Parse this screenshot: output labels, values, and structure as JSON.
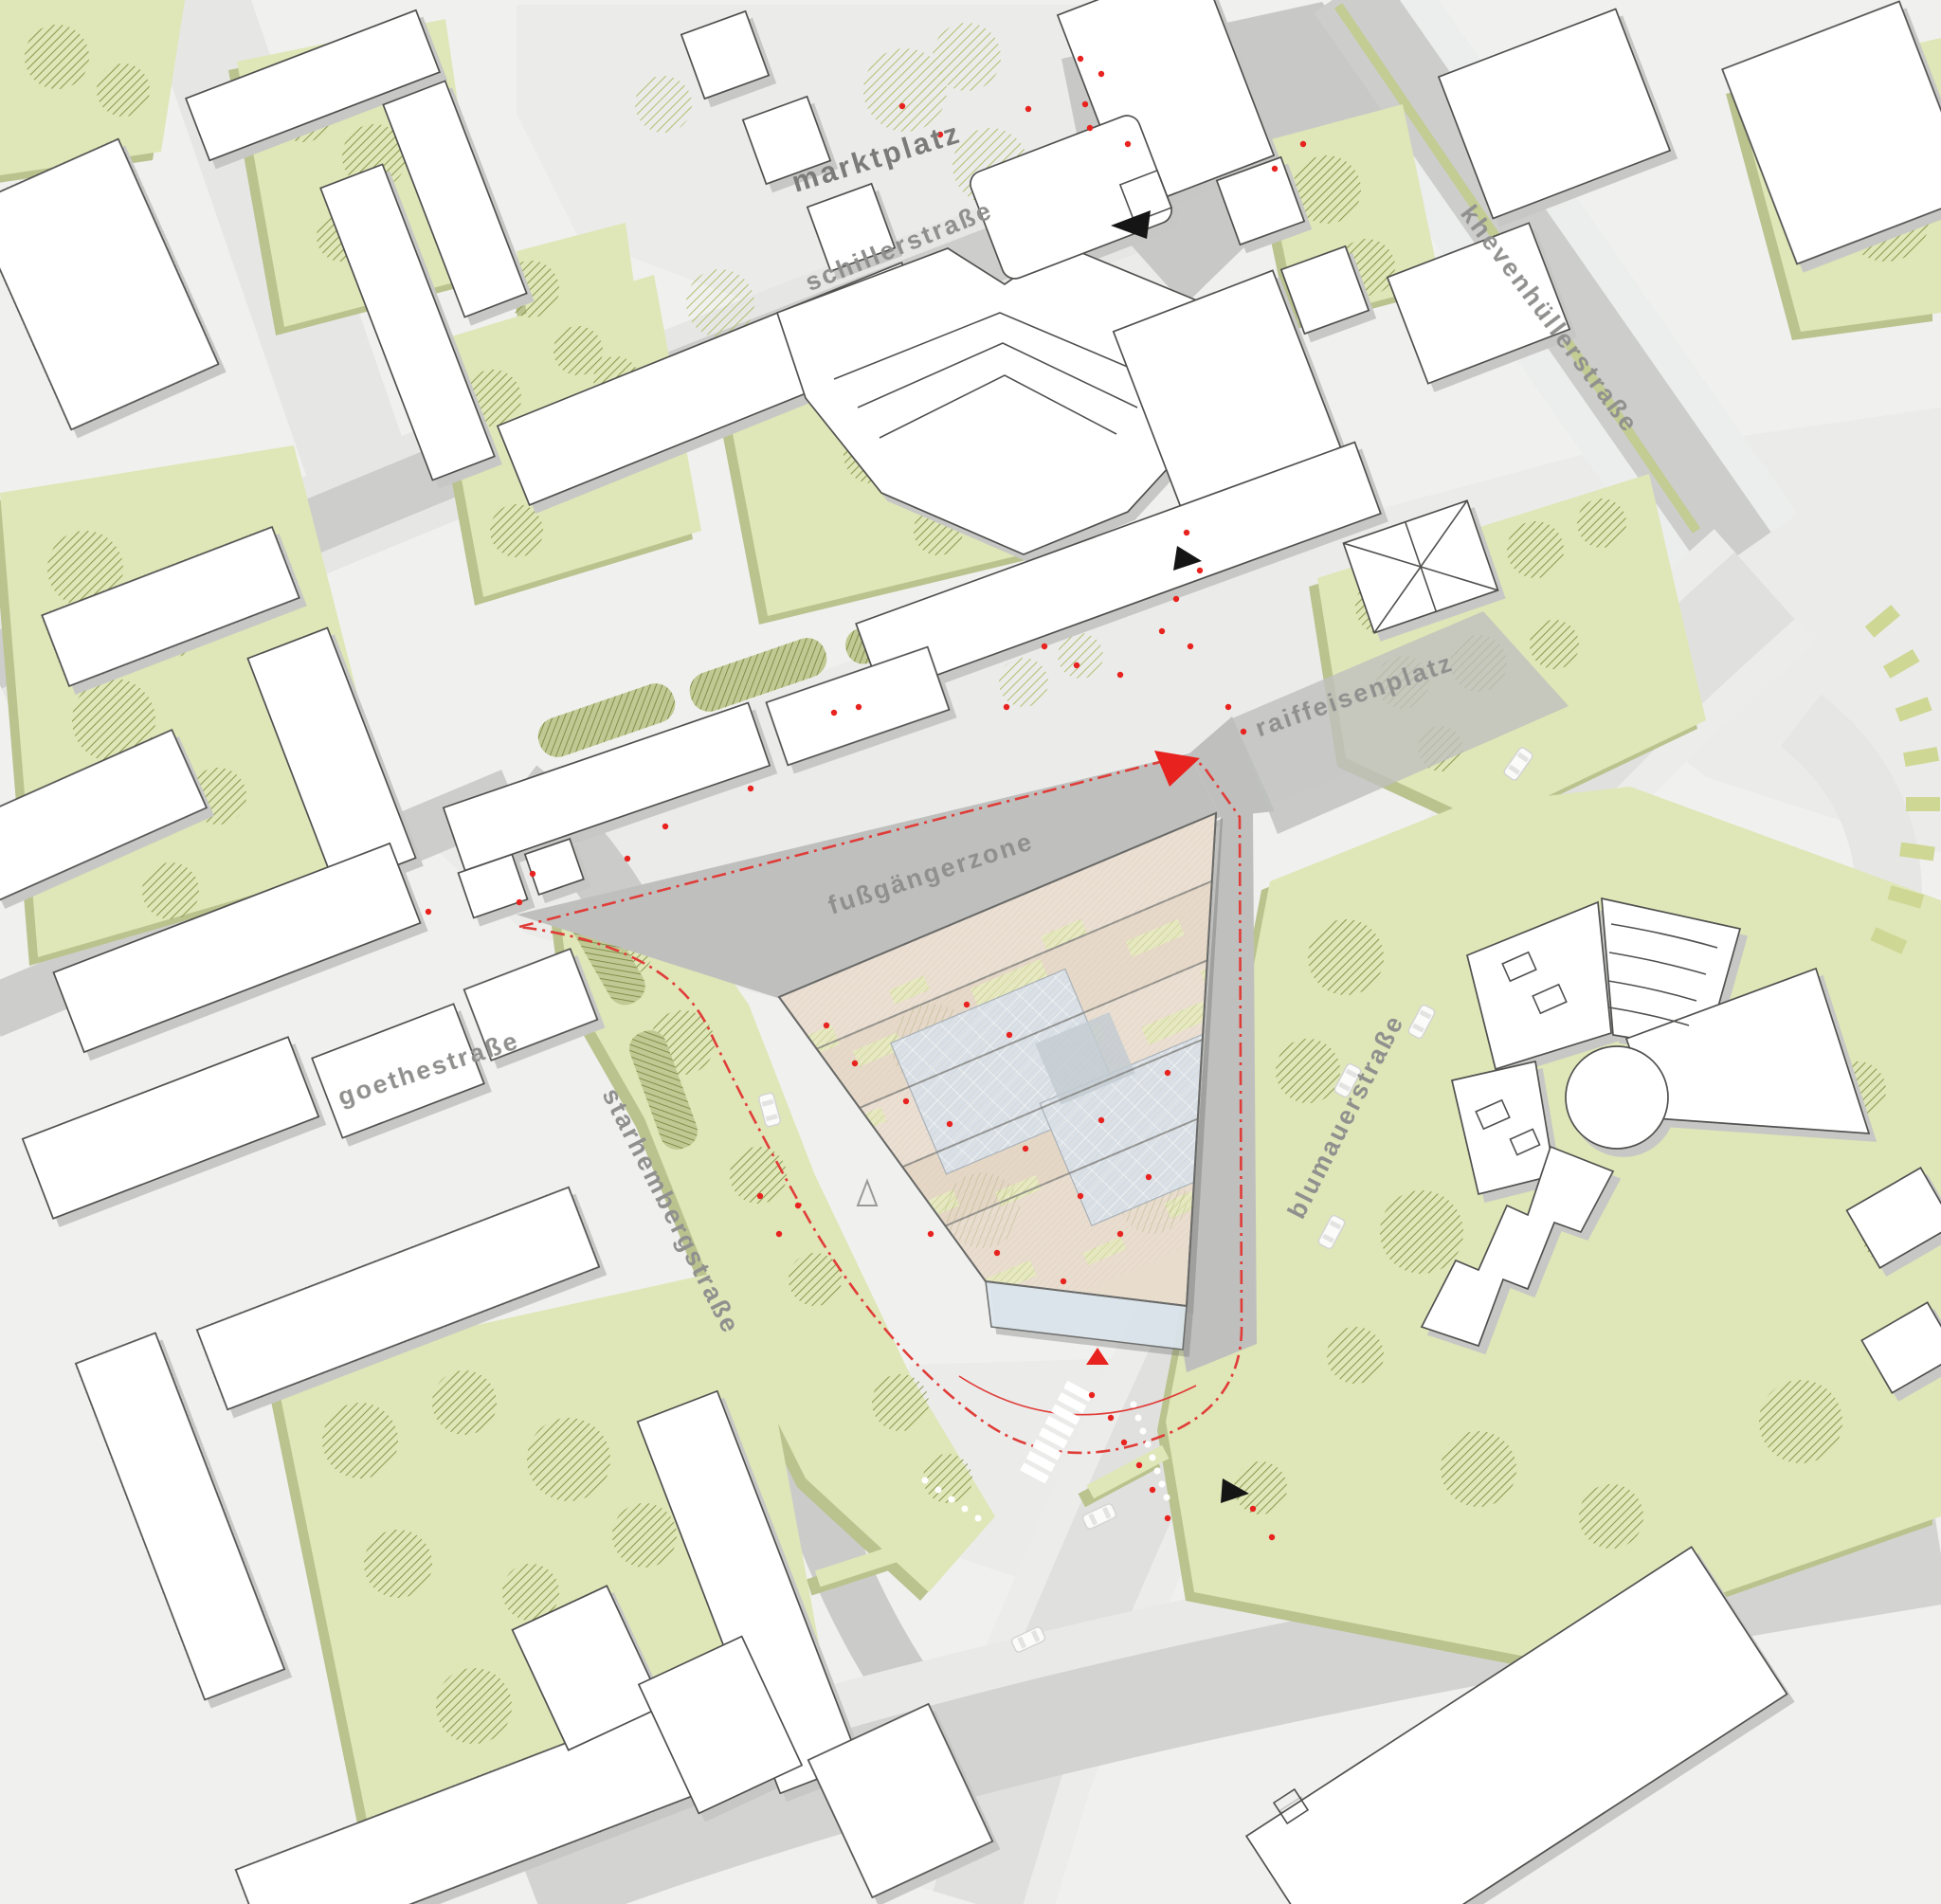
{
  "map": {
    "type": "architectural-site-plan",
    "labels": {
      "places": {
        "marktplatz": "marktplatz",
        "raiffeisenplatz": "raiffeisenplatz",
        "fussgaengerzone": "fußgängerzone"
      },
      "streets": {
        "schillerstrasse": "schillerstraße",
        "khevenhuellerstrasse": "khevenhüllerstraße",
        "goethestrasse": "goethestraße",
        "starhembergstrasse": "starhembergstraße",
        "blumauerstrasse": "blumauerstraße"
      }
    },
    "markers": {
      "entrance_marker": "red-triangle",
      "view_arrow": "black-triangle",
      "people": "red-dots",
      "site_boundary": "red-dash-dot-line"
    },
    "colors": {
      "accent_red": "#e8231f",
      "boundary_red": "#e03c38",
      "green_light": "#dfe6b7",
      "green_shadow": "#bac28e",
      "tree_hatch": "#8d9a52",
      "roof_beige": "#e8dccd",
      "roof_green_patch": "#e7eac1",
      "glass_blue": "#d9e0e7",
      "road_dark": "#cdcecc",
      "road_light": "#e7e8e6",
      "plaza": "#ebecea",
      "building_fill": "#ffffff",
      "building_outline": "#515150",
      "label_gray": "#90918f"
    }
  }
}
